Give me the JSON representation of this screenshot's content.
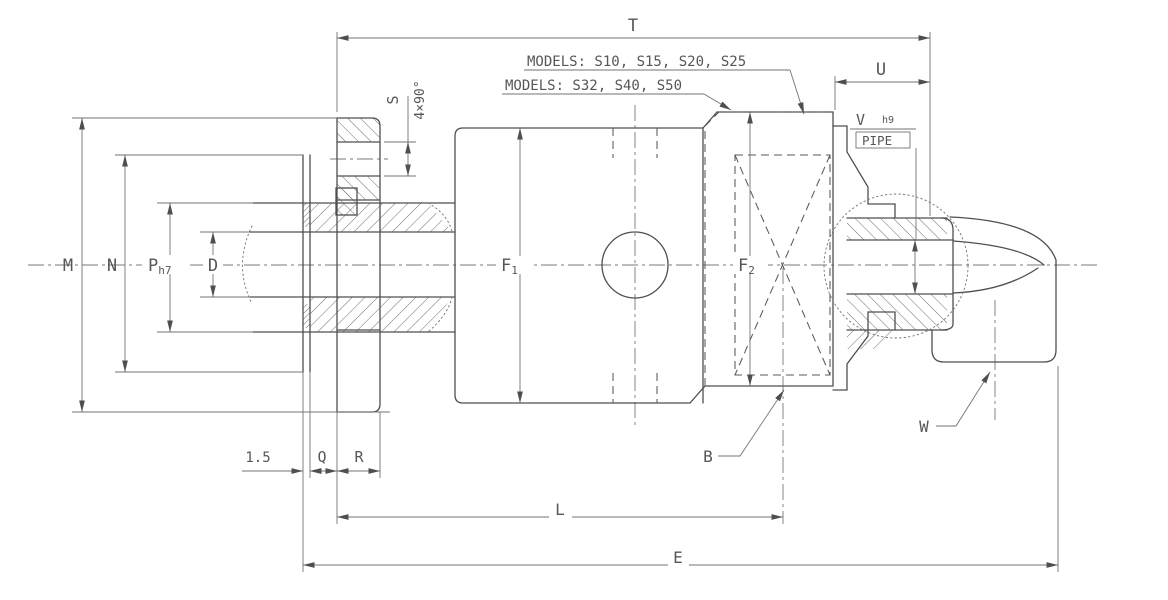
{
  "drawing": {
    "type": "engineering-dimension-drawing",
    "subject": "rotary joint / rotary union side section with elbow outlet",
    "colors": {
      "background": "#ffffff",
      "object_line": "#4f4f4f",
      "dimension_line": "#737373",
      "text": "#565656"
    },
    "labels": {
      "t": "T",
      "u": "U",
      "s": "S",
      "s_note": "4×90°",
      "v": "V",
      "v_tol": "h9",
      "pipe": "PIPE",
      "models_a": "MODELS: S10, S15, S20, S25",
      "models_b": "MODELS: S32, S40, S50",
      "m": "M",
      "n": "N",
      "p": "P",
      "p_tol": "h7",
      "d": "D",
      "f": "F",
      "f1_sub": "1",
      "f2_sub": "2",
      "gap": "1.5",
      "q": "Q",
      "r": "R",
      "l": "L",
      "e": "E",
      "b": "B",
      "w": "W"
    }
  }
}
